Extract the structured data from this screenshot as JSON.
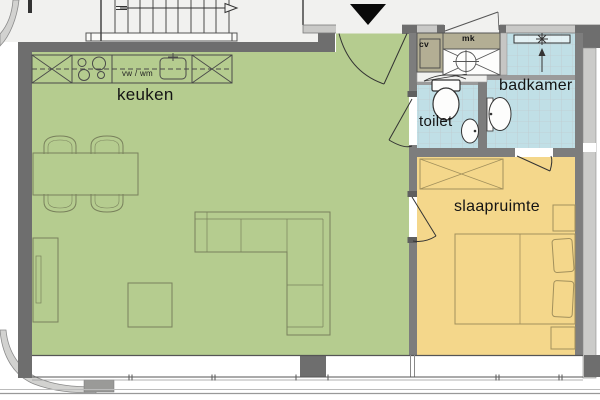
{
  "rooms": {
    "kitchen_living": {
      "label": "keuken",
      "color": "#b5cc8f"
    },
    "toilet": {
      "label": "toilet",
      "color": "#c0dfe6"
    },
    "bathroom": {
      "label": "badkamer",
      "color": "#c0dfe6"
    },
    "bedroom": {
      "label": "slaapruimte",
      "color": "#f4d78b"
    }
  },
  "annotations": {
    "dishwasher_washer": "vw / wm",
    "central_heating_closet": "cv",
    "meter_cupboard": "mk"
  },
  "palette": {
    "wall_dark": "#6e6e6e",
    "wall_partition": "#7d7d7d",
    "wall_light_band": "#c9c9c7",
    "closet_khaki": "#b3ae94",
    "common_area_bg": "#f1f1ef",
    "entrance_marker_black": "#0a0a0a",
    "fixture_white": "#fdfdfc"
  },
  "icons": {
    "entrance_marker": "down-triangle",
    "stair_direction": "right-arrow",
    "shower_slope": "up-arrow",
    "cabinet_cross": "x-cross"
  }
}
